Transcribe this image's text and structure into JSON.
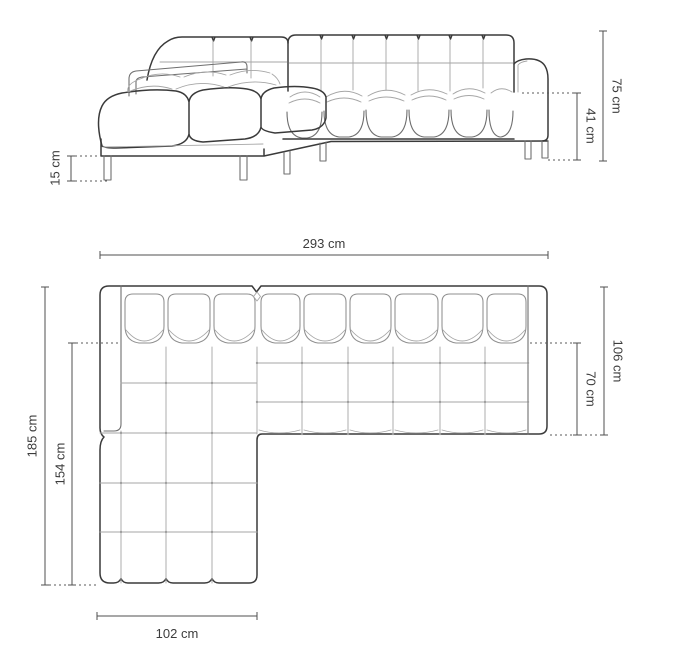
{
  "colors": {
    "outline": "#3a3a3a",
    "interior_lines": "#a6a6a6",
    "dimension_lines": "#4f4f4f",
    "label_text": "#3c3c3c",
    "background": "#ffffff"
  },
  "side_view": {
    "dims": {
      "total_height": "75 cm",
      "seat_height": "41 cm",
      "leg_height": "15 cm"
    }
  },
  "top_view": {
    "dims": {
      "total_width": "293 cm",
      "total_depth": "106 cm",
      "seat_depth": "70 cm",
      "chaise_total_depth": "185 cm",
      "chaise_length": "154 cm",
      "chaise_width": "102 cm"
    }
  }
}
